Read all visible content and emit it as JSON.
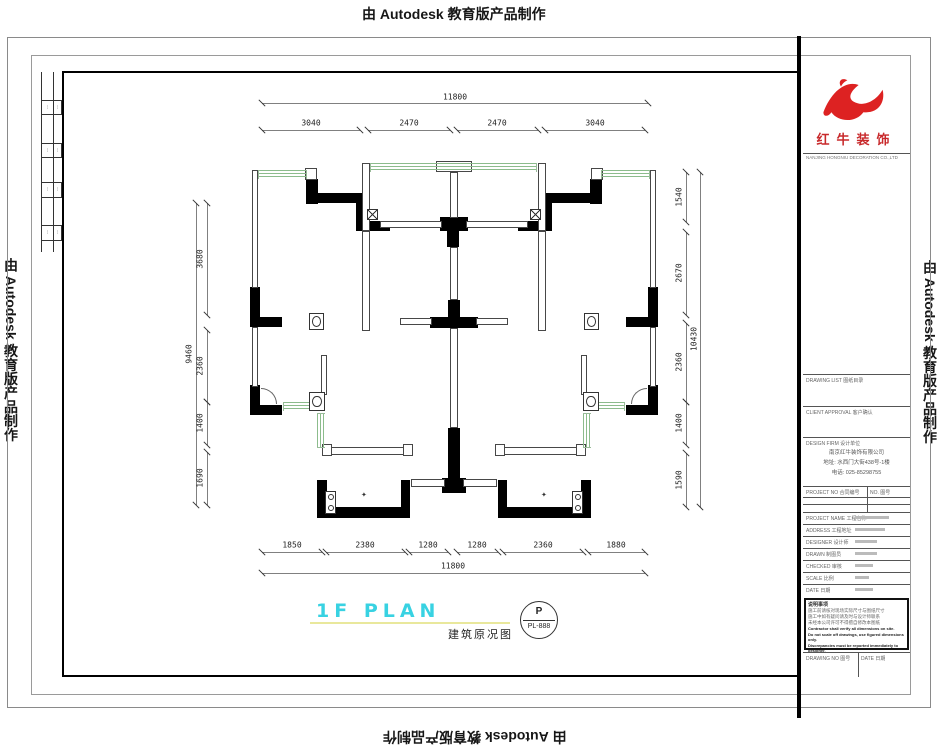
{
  "edges": {
    "top": "由 Autodesk 教育版产品制作",
    "bottom": "由 Autodesk 教育版产品制作",
    "left": "由 Autodesk 教育版产品制作",
    "right": "由 Autodesk 教育版产品制作"
  },
  "plan": {
    "title": "1F PLAN",
    "subtitle": "建筑原况图",
    "stamp": {
      "top": "P",
      "bottom": "PL-888"
    },
    "dims": {
      "top_overall": "11800",
      "top_segs": [
        "3040",
        "2470",
        "2470",
        "3040"
      ],
      "bottom_segs": [
        "1850",
        "2380",
        "1280",
        "1280",
        "2360",
        "1880"
      ],
      "bottom_overall": "11800",
      "left_overall": "9460",
      "left_segs": [
        "3680",
        "2360",
        "1400",
        "1690"
      ],
      "right_segs": [
        "1540",
        "2670",
        "2360",
        "1400",
        "1590"
      ],
      "right_overall": "10430"
    }
  },
  "titleblock": {
    "brand": "红牛装饰",
    "brand_caption": "NANJING HONGNIU DECORATION CO.,LTD",
    "sections": {
      "s1": "DRAWING LIST 图纸目录",
      "s2": "CLIENT APPROVAL 客户确认",
      "s3": "DESIGN FIRM 设计单位"
    },
    "company": {
      "name": "南京红牛装饰有限公司",
      "addr": "地址: 水西门大街438号-1楼",
      "tel": "电话: 025-85298755"
    },
    "header2": {
      "left": "PROJECT NO 合同编号",
      "right": "NO. 图号"
    },
    "rows": [
      {
        "label": "PROJECT NAME 工程名称"
      },
      {
        "label": "ADDRESS 工程地址"
      },
      {
        "label": "DESIGNER 设计师"
      },
      {
        "label": "DRAWN 制图员"
      },
      {
        "label": "CHECKED 审核"
      },
      {
        "label": "SCALE 比例"
      },
      {
        "label": "DATE 日期"
      }
    ],
    "notes_title": "说明事项",
    "notes_cn_1": "施工前请核对现场实际尺寸与图纸尺寸",
    "notes_cn_2": "施工中如有疑问请及时与设计师联系",
    "notes_cn_3": "未经本公司许可不得擅自修改本图纸",
    "notes_en_1": "Contractor shall verify all dimensions on site.",
    "notes_en_2": "Do not scale off drawings, use figured dimensions only.",
    "notes_en_3": "Discrepancies must be reported immediately to designer.",
    "footer": {
      "left": "DRAWING NO 图号",
      "right": "DATE 日期"
    }
  }
}
